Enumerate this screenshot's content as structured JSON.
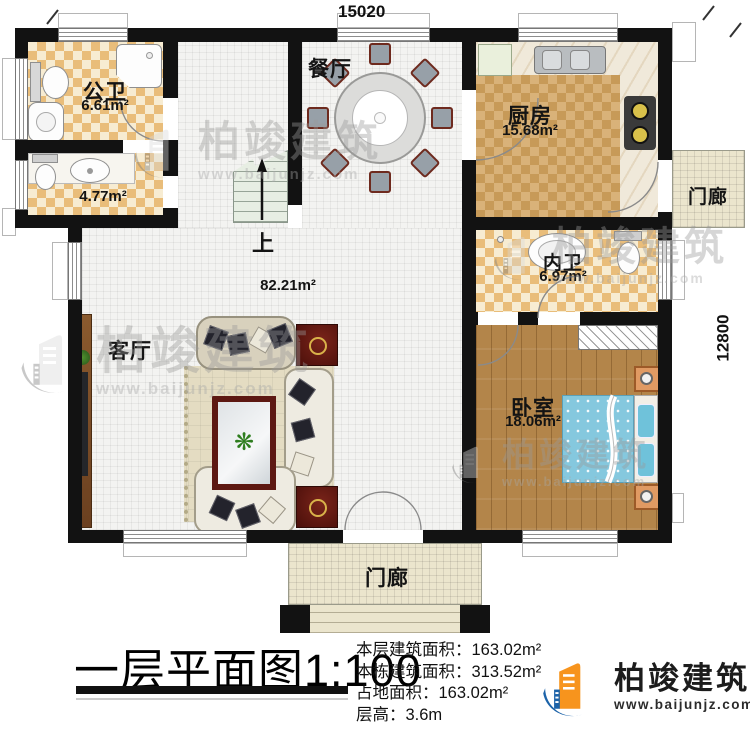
{
  "plan": {
    "dim_top": "15020",
    "dim_right": "12800",
    "rooms": {
      "public_bath": {
        "name": "公卫",
        "area": "6.61m²"
      },
      "wash": {
        "area": "4.77m²"
      },
      "dining": {
        "name": "餐厅"
      },
      "kitchen": {
        "name": "厨房",
        "area": "15.68m²"
      },
      "porch_right": {
        "name": "门廊"
      },
      "inner_bath": {
        "name": "内卫",
        "area": "6.97m²"
      },
      "bedroom": {
        "name": "卧室",
        "area": "18.06m²"
      },
      "living": {
        "name": "客厅"
      },
      "hall_area": "82.21m²",
      "stairs_up": "上",
      "porch_bottom": {
        "name": "门廊"
      }
    }
  },
  "footer": {
    "title": "一层平面图",
    "scale": "1:100",
    "stats": [
      {
        "label": "本层建筑面积：",
        "value": "163.02m²"
      },
      {
        "label": "本栋建筑面积：",
        "value": "313.52m²"
      },
      {
        "label": "占地面积：",
        "value": "163.02m²"
      },
      {
        "label": "层高：",
        "value": "3.6m"
      }
    ],
    "brand": {
      "name": "柏竣建筑",
      "url": "www.baijunjz.com"
    }
  },
  "watermark": {
    "name": "柏竣建筑",
    "url": "www.baijunjz.com"
  },
  "colors": {
    "wall": "#121212",
    "checker": "#e9bd7a",
    "kitchen_checker": "#c79a58",
    "wood_floor": "#b3854a",
    "bed": "#85c8de",
    "logo_blue": "#1c63a9",
    "logo_orange": "#f7941d",
    "table_red": "#5d1812"
  }
}
